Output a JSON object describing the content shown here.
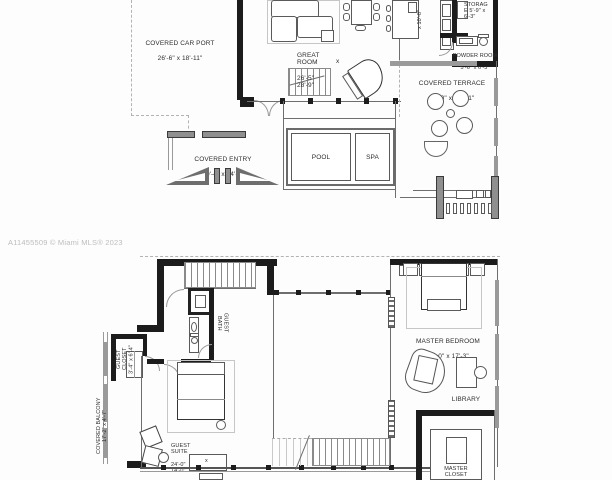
{
  "watermark": "A11455509 © Miami MLS® 2023",
  "colors": {
    "wall": "#1c1c1c",
    "gray_wall": "#8f8f8f",
    "line": "#6e6e6e",
    "label_ink": "#2e2e2e",
    "watermark": "#bdbdbd"
  },
  "floor1": {
    "carport": {
      "label": "COVERED CAR PORT",
      "dims": "26'-6\" x 18'-11\""
    },
    "great_room": {
      "label": "GREAT\nROOM",
      "dims": "26'-5\"\n28'-9\"",
      "x_mark": "x"
    },
    "kitchen_dim": "x 10'-8\"",
    "storage": {
      "label": "STORAG\nE 5'-9\" x\n6'-3\""
    },
    "powder": {
      "label": "POWDER ROOM",
      "dims": "5'-6\" x 6'-3\""
    },
    "terrace": {
      "label": "COVERED TERRACE",
      "dims": "24'-0\" x 17'-11\""
    },
    "entry": {
      "label": "COVERED ENTRY",
      "dims": "20'-4\" x 14'-8\""
    },
    "pool": {
      "label": "POOL"
    },
    "spa": {
      "label": "SPA"
    }
  },
  "floor2": {
    "master_bedroom": {
      "label": "MASTER BEDROOM",
      "dims": "24'-0\" x 17'-3\""
    },
    "library": {
      "label": "LIBRARY"
    },
    "master_closet": {
      "label": "MASTER\nCLOSET"
    },
    "guest_suite": {
      "label": "GUEST\nSUITE",
      "dims": "24'-0\"\n14'-0\"",
      "x_mark": "x"
    },
    "guest_bath": {
      "label": "GUEST\nBATH"
    },
    "guest_closet": {
      "label": "GUEST CLOSET\n3'-4\" x 6'-4\""
    },
    "balcony": {
      "label": "COVERED BALCONY\n17'-2\" x 4'-7\""
    }
  }
}
